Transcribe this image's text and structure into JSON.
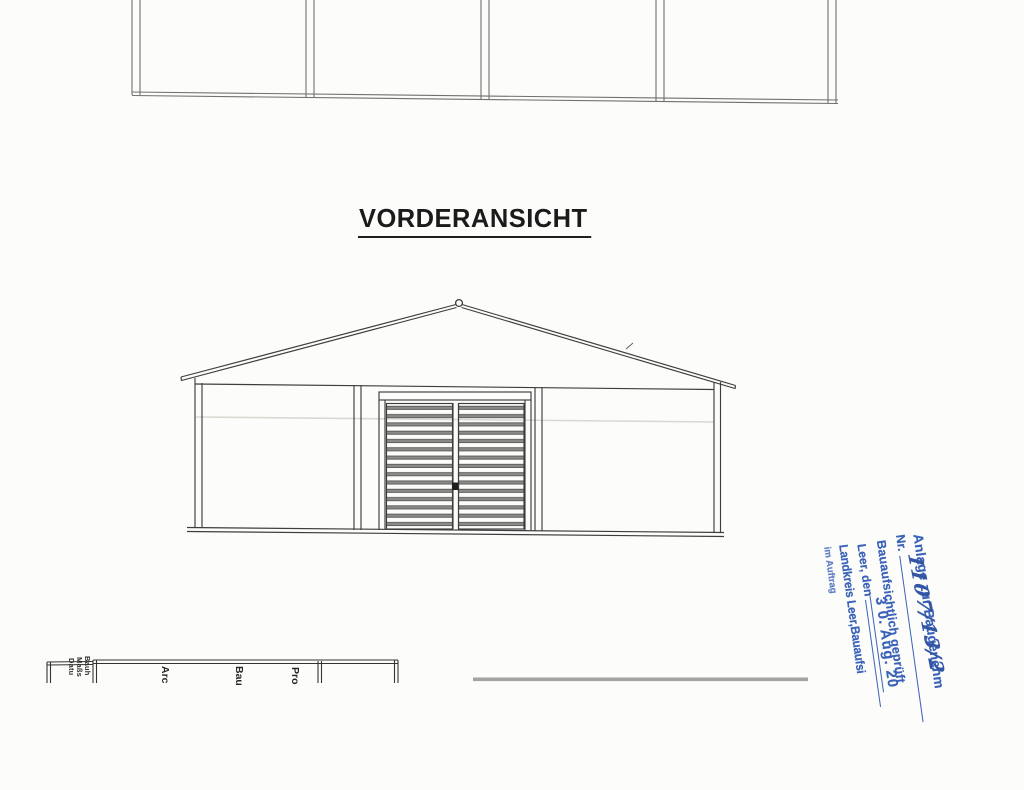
{
  "title": {
    "text": "VORDERANSICHT"
  },
  "stamp": {
    "color": "#3a62b8",
    "line1": "Anlage zur Baugenehm",
    "nr_label": "Nr.",
    "nr_value": "1107/13/2",
    "line3": "Bauaufsichtlich geprüft",
    "place_label": "Leer, den",
    "date_value": "3 0. Aug. 20",
    "line5": "Landkreis Leer,Bauaufsi",
    "line6": "im Auftrag"
  },
  "title_block": {
    "field_owner": "Bauh",
    "field_scale": "Maßs",
    "field_date": "Datu",
    "col_architect": "Arc",
    "col_project": "Bau",
    "col_check": "Pro"
  }
}
